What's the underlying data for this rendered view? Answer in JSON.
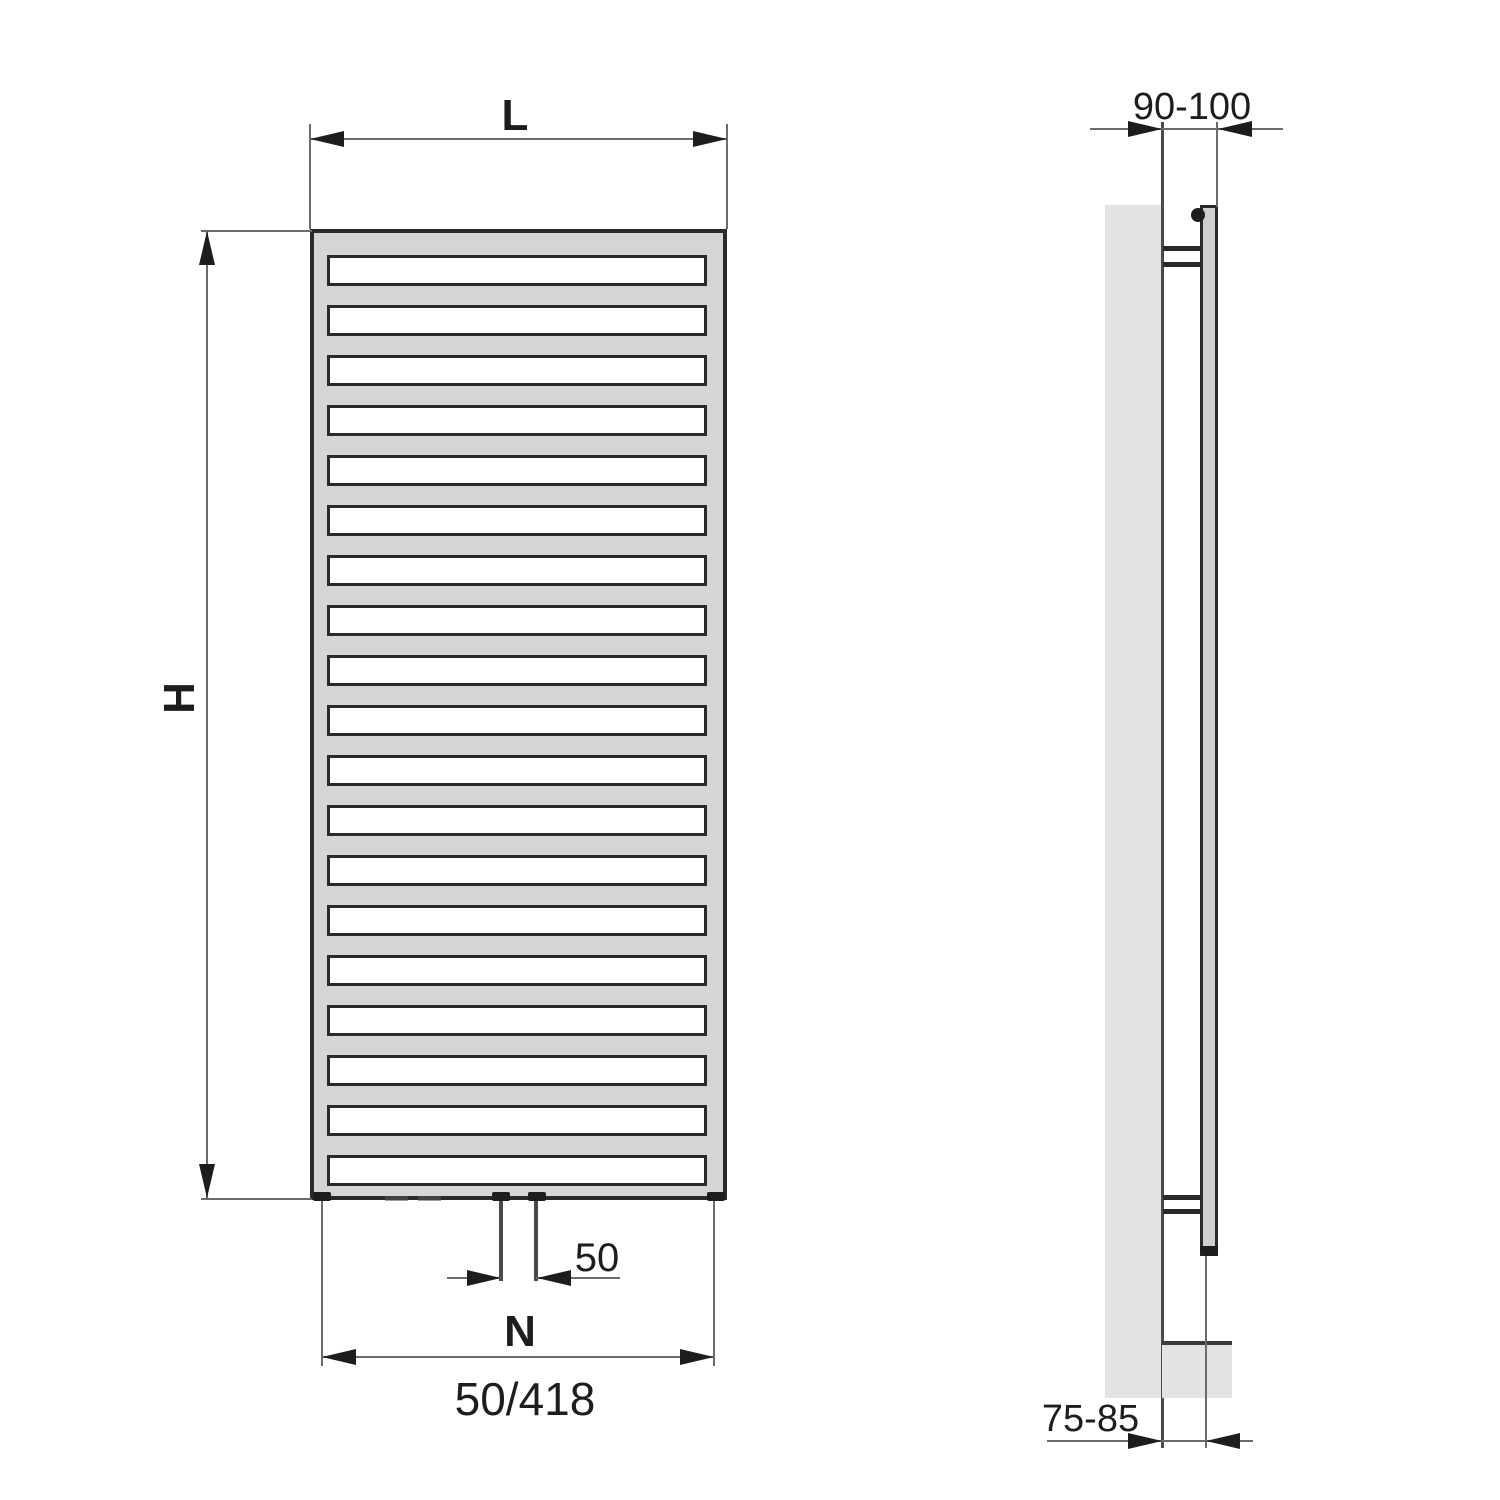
{
  "drawing": {
    "front_view": {
      "width_label": "L",
      "height_label": "H",
      "pipe_spacing_label": "50",
      "connection_span_label": "N",
      "connection_code_label": "50/418",
      "rung_count": 19
    },
    "side_view": {
      "wall_to_front_label": "90-100",
      "wall_to_pipe_label": "75-85"
    },
    "colors": {
      "line_dark": "#2a2a2c",
      "ink": "#1d1d1f",
      "dimension_gray": "#6b6b6d",
      "frame_gray": "#d3d5d7",
      "wall_gray": "#e3e3e5",
      "tube_gray": "#cdcfd1"
    }
  }
}
